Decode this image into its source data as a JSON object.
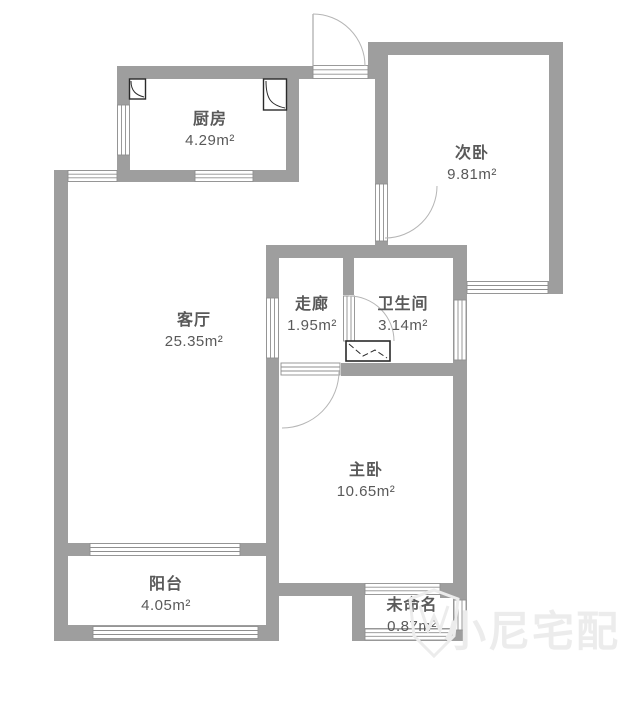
{
  "plan": {
    "type": "apartment-floor-plan",
    "rooms": [
      {
        "id": "kitchen",
        "name": "厨房",
        "area": "4.29m²"
      },
      {
        "id": "second-bedroom",
        "name": "次卧",
        "area": "9.81m²"
      },
      {
        "id": "living-room",
        "name": "客厅",
        "area": "25.35m²"
      },
      {
        "id": "corridor",
        "name": "走廊",
        "area": "1.95m²"
      },
      {
        "id": "bathroom",
        "name": "卫生间",
        "area": "3.14m²"
      },
      {
        "id": "master-bedroom",
        "name": "主卧",
        "area": "10.65m²"
      },
      {
        "id": "balcony",
        "name": "阳台",
        "area": "4.05m²"
      },
      {
        "id": "unnamed",
        "name": "未命名",
        "area": "0.87m²"
      }
    ],
    "symbols": [
      "entry-door-arc",
      "bedroom-door-arc",
      "bathroom-door-arc",
      "master-door-arc",
      "kitchen-flue-left",
      "kitchen-flue-right",
      "bathroom-flue",
      "windows-on-exterior-and-interior-walls"
    ],
    "colors": {
      "wall": "#9e9e9e",
      "text": "#595959",
      "arc_line": "#b5b5b5",
      "window_stroke": "#8f8f8f",
      "flue_stroke": "#2a2a2a",
      "watermark": "#ececec"
    }
  },
  "watermark": {
    "text": "小尼宅配",
    "logo_icon": "shield-logo-icon"
  }
}
